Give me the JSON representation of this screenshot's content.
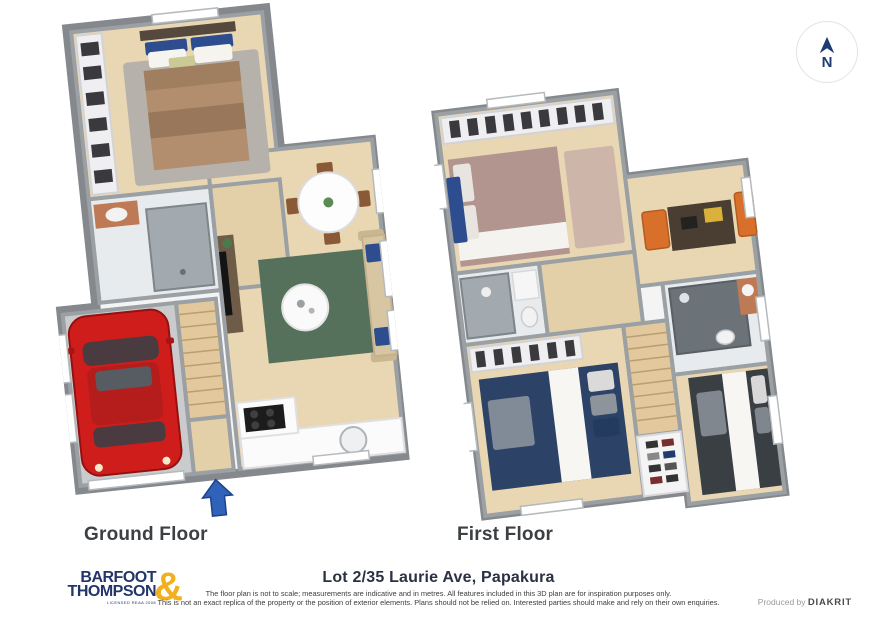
{
  "canvas": {
    "width": 877,
    "height": 640,
    "background": "#ffffff"
  },
  "compass": {
    "label": "N",
    "arrow_color": "#1e3c72",
    "circle_border": "#e3e3e3"
  },
  "plans": {
    "ground": {
      "label": "Ground Floor",
      "features": [
        "garage",
        "red-car",
        "garage-door",
        "stairs",
        "double-bedroom",
        "wardrobe",
        "bathroom-shower",
        "vanity",
        "hallway",
        "living-area",
        "sofa-with-blue-cushions",
        "green-rug",
        "round-coffee-table",
        "tv-unit",
        "round-dining-table",
        "dining-chairs",
        "kitchen-cooktop",
        "kitchen-sink",
        "entry-arrow"
      ]
    },
    "first": {
      "label": "First Floor",
      "features": [
        "master-bedroom",
        "wardrobe-row",
        "ensuite-shower",
        "study-nook",
        "desk",
        "orange-armchairs",
        "hallway",
        "stairs",
        "shoe-closet",
        "bedroom-2-navy-bed",
        "bathroom-dark-tile",
        "vanity",
        "bedroom-3-charcoal-bed"
      ]
    }
  },
  "footer": {
    "address_title": "Lot 2/35 Laurie Ave, Papakura",
    "disclaimer_line_1": "The floor plan is not to scale; measurements are indicative and in metres. All features included in this 3D plan are for inspiration purposes only.",
    "disclaimer_line_2": "This is not an exact replica of the property or the position of exterior elements. Plans should not be relied on. Interested parties should make and rely on their own enquiries.",
    "produced_by_label": "Produced by ",
    "producer_name": "DIAKRIT"
  },
  "brand": {
    "word1": "BARFOOT",
    "word2": "THOMPSON",
    "ampersand": "&",
    "tagline": "LICENSED REAA 2008",
    "navy": "#23356b",
    "gold": "#f2b01e"
  },
  "colors": {
    "wall_gray": "#85898d",
    "wood_floor": "#e9d6b2",
    "garage_floor": "#c9cbcd",
    "shower_tile": "#a2aab0",
    "dark_tile": "#6b7278",
    "car_red": "#cf1d1c",
    "rug_green": "#55715b",
    "bed_navy": "#2c4266",
    "bed_mauve": "#b1958e",
    "bed_brown": "#b28d6e",
    "bed_charcoal": "#3a3f44",
    "chair_orange": "#d8702b",
    "pillow_blue": "#2d4d8e",
    "entry_arrow_blue": "#2f62b8"
  }
}
